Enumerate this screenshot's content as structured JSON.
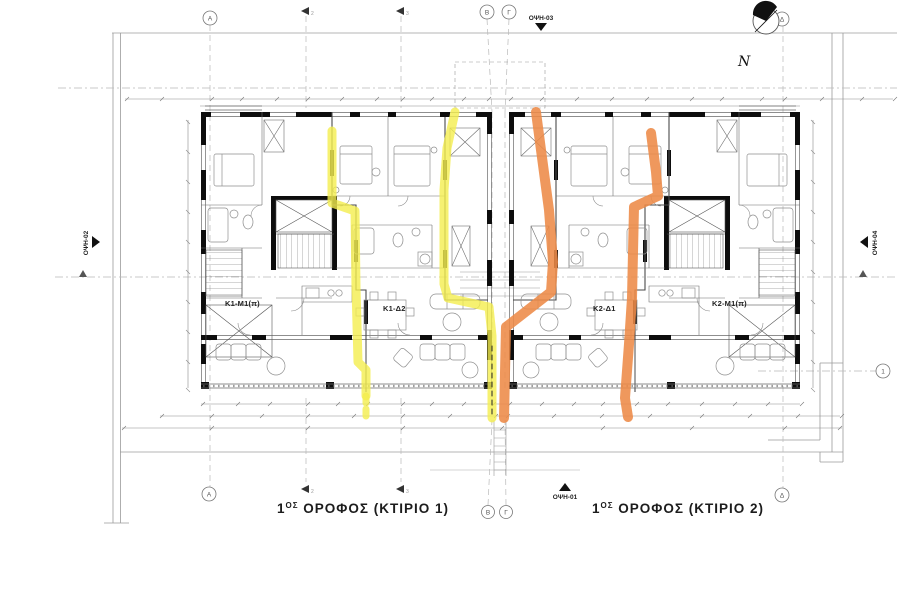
{
  "north": {
    "label": "N"
  },
  "elevations": {
    "top": "ΟΨΗ-03",
    "bottom": "ΟΨΗ-01",
    "left": "ΟΨΗ-02",
    "right": "ΟΨΗ-04"
  },
  "grid": {
    "top": [
      "Α",
      "Β",
      "Γ",
      "Δ"
    ],
    "bottom": [
      "Α",
      "Β",
      "Γ",
      "Δ"
    ],
    "right": [
      "1"
    ],
    "sections_top": [
      "2",
      "3"
    ],
    "sections_bottom": [
      "2",
      "3"
    ]
  },
  "apartments": [
    {
      "id": "b1-left",
      "label": "Κ1-Μ1(π)"
    },
    {
      "id": "b1-right",
      "label": "Κ1-Δ2"
    },
    {
      "id": "b2-left",
      "label": "Κ2-Δ1"
    },
    {
      "id": "b2-right",
      "label": "Κ2-Μ1(π)"
    }
  ],
  "titles": {
    "b1": {
      "num": "1",
      "sup": "ΟΣ",
      "rest": " ΟΡΟΦΟΣ  (ΚΤΙΡΙΟ 1)"
    },
    "b2": {
      "num": "1",
      "sup": "ΟΣ",
      "rest": " ΟΡΟΦΟΣ  (ΚΤΙΡΙΟ 2)"
    }
  },
  "highlights": {
    "yellow": "#f4ee4e",
    "orange": "#ed8a47"
  }
}
